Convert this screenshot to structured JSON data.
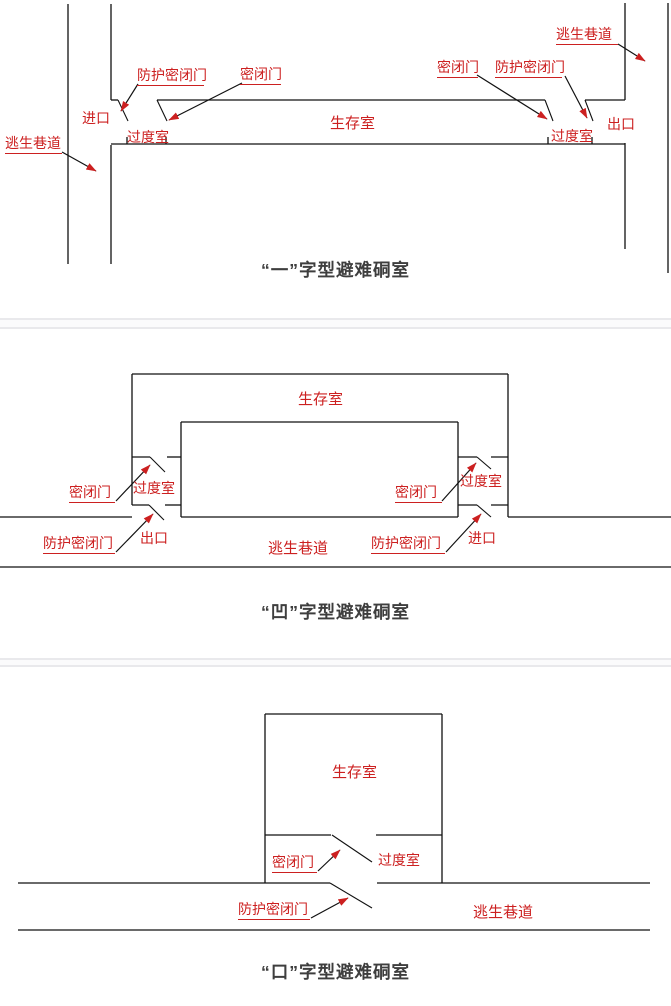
{
  "page": {
    "colors": {
      "background": "#ffffff",
      "line": "#111111",
      "label": "#cc2020",
      "title": "#3e3e3e",
      "separator": "#f2f2f4"
    }
  },
  "sections": [
    {
      "title": "“一”字型避难硐室",
      "labels": {
        "escape_left": "逃生巷道",
        "entrance": "进口",
        "protective_left": "防护密闭门",
        "sealed_left": "密闭门",
        "transition_left": "过度室",
        "survival": "生存室",
        "sealed_right": "密闭门",
        "protective_right": "防护密闭门",
        "escape_right": "逃生巷道",
        "transition_right": "过度室",
        "exit": "出口"
      }
    },
    {
      "title": "“凹”字型避难硐室",
      "labels": {
        "sealed_left": "密闭门",
        "transition_left": "过度室",
        "protective_left": "防护密闭门",
        "exit": "出口",
        "survival": "生存室",
        "escape": "逃生巷道",
        "sealed_right": "密闭门",
        "transition_right": "过度室",
        "protective_right": "防护密闭门",
        "entrance": "进口"
      }
    },
    {
      "title": "“口”字型避难硐室",
      "labels": {
        "survival": "生存室",
        "sealed": "密闭门",
        "transition": "过度室",
        "protective": "防护密闭门",
        "escape": "逃生巷道"
      }
    }
  ]
}
